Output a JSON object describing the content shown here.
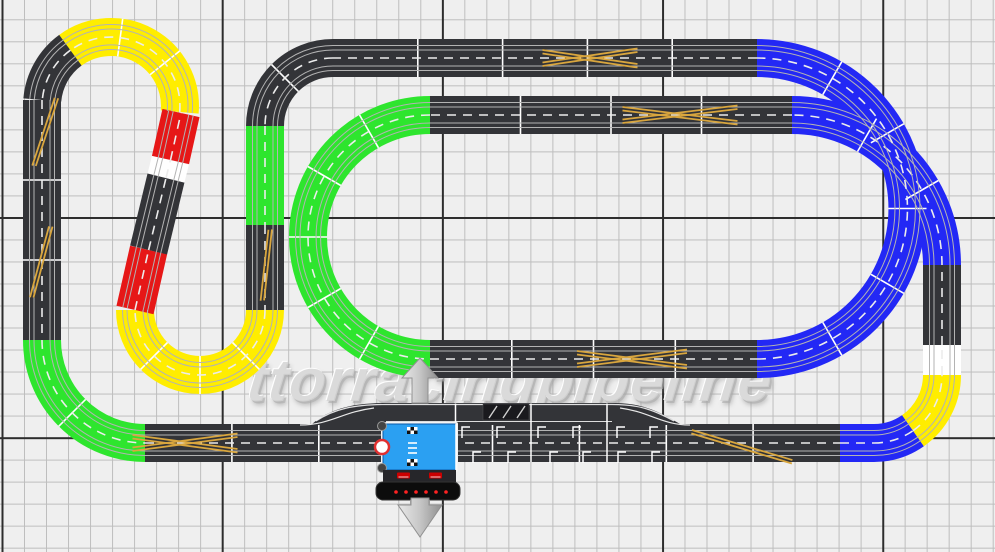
{
  "watermark": {
    "text": "ttorracingpipeline"
  },
  "colors": {
    "background": "#efefef",
    "grid_minor": "#bdbdbd",
    "grid_major": "#2d2d2d",
    "piece_dark": "#333438",
    "piece_yellow": "#ffed00",
    "piece_green": "#2ee52e",
    "piece_blue": "#2328f5",
    "piece_red": "#e61717",
    "piece_white": "#ffffff",
    "slot_line": "#b3b3b3",
    "lane_dash": "#ececec",
    "joint_line": "#ffffff",
    "crossover": "#d9a63e",
    "powerbase_blue": "#2ba0f2",
    "powerbase_dark": "#26262a",
    "led_red": "#ff2222",
    "arrow_gray": "#c6c6c6"
  },
  "track": {
    "width": 38,
    "segments": [
      {
        "kind": "arc",
        "cx": 111,
        "cy": 106,
        "r": 69,
        "a0": 5,
        "a1": -126,
        "color": "yellow"
      },
      {
        "kind": "arc",
        "cx": 111,
        "cy": 106,
        "r": 69,
        "a0": -126,
        "a1": -175,
        "color": "dark"
      },
      {
        "kind": "line",
        "x1": 42,
        "y1": 100,
        "x2": 42,
        "y2": 340,
        "color": "dark"
      },
      {
        "kind": "arc",
        "cx": 145,
        "cy": 340,
        "r": 103,
        "a0": 180,
        "a1": 90,
        "color": "green"
      },
      {
        "kind": "line",
        "x1": 145,
        "y1": 443,
        "x2": 840,
        "y2": 443,
        "color": "dark"
      },
      {
        "kind": "line",
        "x1": 840,
        "y1": 443,
        "x2": 874,
        "y2": 443,
        "color": "blue"
      },
      {
        "kind": "arc",
        "cx": 874,
        "cy": 375,
        "r": 68,
        "a0": 90,
        "a1": 55,
        "color": "blue"
      },
      {
        "kind": "arc",
        "cx": 874,
        "cy": 375,
        "r": 68,
        "a0": 55,
        "a1": 0,
        "color": "yellow"
      },
      {
        "kind": "line",
        "x1": 942,
        "y1": 375,
        "x2": 942,
        "y2": 345,
        "color": "white"
      },
      {
        "kind": "line",
        "x1": 942,
        "y1": 345,
        "x2": 942,
        "y2": 265,
        "color": "dark"
      },
      {
        "kind": "arc",
        "cx": 792,
        "cy": 265,
        "r": 150,
        "a0": 0,
        "a1": -90,
        "color": "blue"
      },
      {
        "kind": "line",
        "x1": 792,
        "y1": 115,
        "x2": 430,
        "y2": 115,
        "color": "dark"
      },
      {
        "kind": "arc",
        "cx": 430,
        "cy": 237,
        "r": 122,
        "a0": 270,
        "a1": 90,
        "color": "green"
      },
      {
        "kind": "line",
        "x1": 430,
        "y1": 359,
        "x2": 757,
        "y2": 359,
        "color": "dark"
      },
      {
        "kind": "arc",
        "cx": 757,
        "cy": 208.5,
        "r": 150.5,
        "a0": 90,
        "a1": -90,
        "color": "blue"
      },
      {
        "kind": "line",
        "x1": 757,
        "y1": 58,
        "x2": 333,
        "y2": 58,
        "color": "dark"
      },
      {
        "kind": "arc",
        "cx": 333,
        "cy": 126,
        "r": 68,
        "a0": 270,
        "a1": 180,
        "color": "dark"
      },
      {
        "kind": "line",
        "x1": 265,
        "y1": 126,
        "x2": 265,
        "y2": 225,
        "color": "green"
      },
      {
        "kind": "line",
        "x1": 265,
        "y1": 225,
        "x2": 265,
        "y2": 310,
        "color": "dark"
      },
      {
        "kind": "arc",
        "cx": 200,
        "cy": 310,
        "r": 65,
        "a0": 0,
        "a1": 180,
        "color": "yellow"
      },
      {
        "kind": "line",
        "x1": 135,
        "y1": 310,
        "x2": 148.6,
        "y2": 250,
        "color": "red"
      },
      {
        "kind": "line",
        "x1": 148.6,
        "y1": 250,
        "x2": 166,
        "y2": 178,
        "color": "dark"
      },
      {
        "kind": "line",
        "x1": 166,
        "y1": 178,
        "x2": 170.5,
        "y2": 160,
        "color": "white"
      },
      {
        "kind": "line",
        "x1": 170.5,
        "y1": 160,
        "x2": 181,
        "y2": 113,
        "color": "red"
      }
    ],
    "crossovers": [
      {
        "x": 46,
        "y": 132,
        "angle": 97,
        "len": 70,
        "type": "diag"
      },
      {
        "x": 42,
        "y": 262,
        "angle": 94,
        "len": 72,
        "type": "diag"
      },
      {
        "x": 267,
        "y": 265,
        "angle": 85,
        "len": 70,
        "type": "diag"
      },
      {
        "x": 590,
        "y": 58,
        "angle": 0,
        "len": 95,
        "type": "x"
      },
      {
        "x": 680,
        "y": 115,
        "angle": 0,
        "len": 115,
        "type": "x"
      },
      {
        "x": 632,
        "y": 359,
        "angle": 0,
        "len": 110,
        "type": "x"
      },
      {
        "x": 185,
        "y": 443,
        "angle": 0,
        "len": 105,
        "type": "x"
      },
      {
        "x": 742,
        "y": 446,
        "angle": 9,
        "len": 104,
        "type": "diag"
      }
    ]
  },
  "pit": {
    "shape": "M312 425 L312 424 C330 409 352 403 386 403 L612 403 C640 403 655 409 680 424 L680 425 Z",
    "top_edge": "M316 421 C334 409 354 404.5 386 404.5 L612 404.5 C638 404.5 652 409 674 421",
    "entry_line": "M300 425 C330 425 342 412 374 408",
    "exit_line": "M690 425 C662 425 650 412 620 408",
    "separator": {
      "x1": 386,
      "y1": 421.5,
      "x2": 612,
      "y2": 421.5
    },
    "joint_xs": [
      455.5,
      531,
      607
    ],
    "building": {
      "x": 483,
      "y": 404,
      "w": 46,
      "h": 16
    },
    "upper_marks_y": 427,
    "upper_marks_xs": [
      462,
      497,
      538,
      573,
      617,
      650
    ],
    "lower_marks_y": 452,
    "lower_marks_xs": [
      473,
      508,
      550,
      583,
      618,
      652
    ]
  },
  "powerbase": {
    "x": 383,
    "y": 424,
    "w": 73,
    "h": 46,
    "checkers": [
      {
        "x": 407,
        "y": 427
      },
      {
        "x": 407,
        "y": 459
      }
    ],
    "checker_cell": 3.5,
    "checker_cols": 3,
    "checker_rows": 2,
    "label_x": 408,
    "label_ys": [
      443,
      448,
      453
    ],
    "ring": {
      "cx": 382,
      "cy": 447,
      "r": 7
    },
    "screws": [
      {
        "cx": 382,
        "cy": 426
      },
      {
        "cx": 382,
        "cy": 468
      }
    ],
    "controller_bar": {
      "x": 383,
      "y": 470,
      "w": 73,
      "h": 12
    },
    "chips": [
      {
        "x": 397,
        "y": 472.5
      },
      {
        "x": 429,
        "y": 472.5
      }
    ],
    "chip_w": 13,
    "chip_h": 6,
    "base": {
      "x": 376,
      "y": 482,
      "w": 84,
      "h": 18
    },
    "led_y": 492,
    "led_xs": [
      396,
      406,
      416,
      426,
      436,
      446
    ],
    "pedestal": {
      "x": 410,
      "y": 499,
      "w": 20,
      "h": 8
    }
  },
  "arrows": {
    "up": {
      "x": 420,
      "y": 403
    },
    "down": {
      "x": 420,
      "y": 512
    }
  }
}
